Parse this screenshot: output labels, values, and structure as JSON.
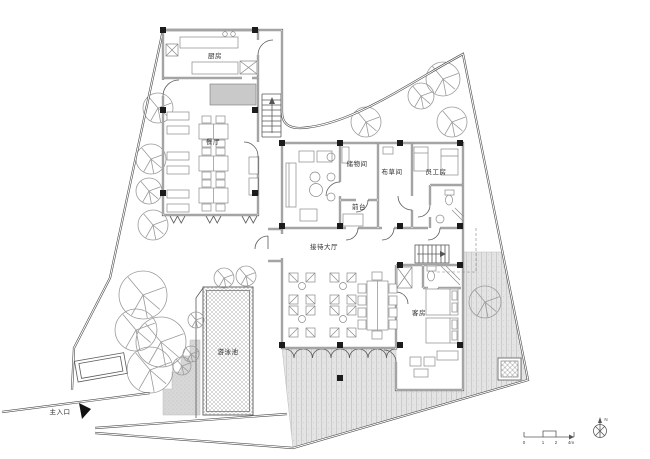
{
  "labels": {
    "kitchen": "厨房",
    "dining": "餐厅",
    "storage": "储物间",
    "linen": "布草间",
    "staff_room": "员工房",
    "front_desk": "前台",
    "reception_hall": "接待大厅",
    "guest_room": "客房",
    "swimming_pool": "游泳池",
    "main_entrance": "主入口"
  },
  "compass": {
    "north": "N"
  },
  "scale_bar": {
    "tick0": "0",
    "tick1": "1",
    "tick2": "2",
    "tick3": "4m"
  },
  "colors": {
    "wall_line": "#4a4a4a",
    "furniture_line": "#8a8a8a",
    "column_fill": "#1c1c1c",
    "terrace_fill": "#e4e4e4",
    "terrace_hatch": "#c6c6c6",
    "pool_hatch": "#a8a8a8",
    "stipple_fill": "#d8d8d8",
    "counter_fill": "#c9c9c9",
    "text": "#2b2b2b"
  }
}
